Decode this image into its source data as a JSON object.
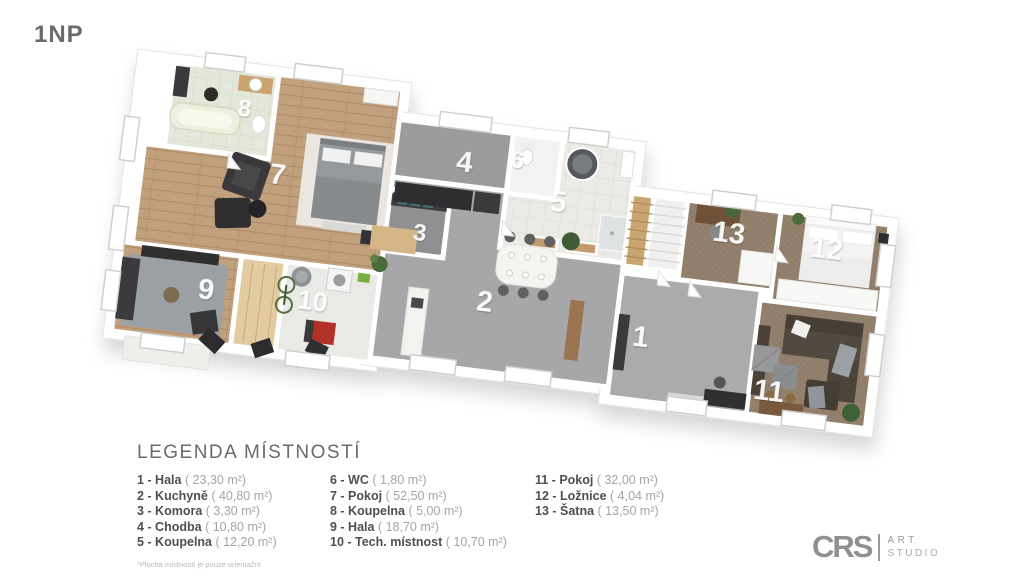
{
  "page": {
    "floor_title": "1NP"
  },
  "legend": {
    "title": "LEGENDA MÍSTNOSTÍ",
    "footnote": "*Plocha místností je pouze orientační",
    "items": [
      {
        "label": "1 - Hala",
        "area": "( 23,30 m²)"
      },
      {
        "label": "2 - Kuchyně",
        "area": "( 40,80 m²)"
      },
      {
        "label": "3 - Komora",
        "area": "( 3,30 m²)"
      },
      {
        "label": "4 - Chodba",
        "area": "( 10,80 m²)"
      },
      {
        "label": "5 - Koupelna",
        "area": "( 12,20 m²)"
      },
      {
        "label": "6 - WC",
        "area": "( 1,80 m²)"
      },
      {
        "label": "7 - Pokoj",
        "area": "( 52,50 m²)"
      },
      {
        "label": "8 - Koupelna",
        "area": "( 5,00 m²)"
      },
      {
        "label": "9 - Hala",
        "area": "( 18,70 m²)"
      },
      {
        "label": "10 - Tech. místnost",
        "area": "( 10,70 m²)"
      },
      {
        "label": "11 - Pokoj",
        "area": "( 32,00 m²)"
      },
      {
        "label": "12 - Ložnice",
        "area": "( 4,04 m²)"
      },
      {
        "label": "13 - Šatna",
        "area": "( 13,50 m²)"
      }
    ]
  },
  "plan": {
    "room_numbers": [
      "1",
      "2",
      "3",
      "4",
      "5",
      "6",
      "7",
      "8",
      "9",
      "10",
      "11",
      "12",
      "13"
    ]
  },
  "logo": {
    "brand": "CRS",
    "top": "ART",
    "bottom": "STUDIO"
  },
  "palette": {
    "wall": "#ffffff",
    "wood_floor": "#c1a07e",
    "carpet": "#8f7c69",
    "concrete": "#a7a7aa",
    "tile": "#ebeae6",
    "furniture_dark": "#3a3a3c",
    "light_wood": "#e3cba1",
    "accent_red": "#b33127",
    "accent_green": "#4a6b3a",
    "text_dark": "#4f4f4f",
    "text_light": "#a5a5a5"
  }
}
